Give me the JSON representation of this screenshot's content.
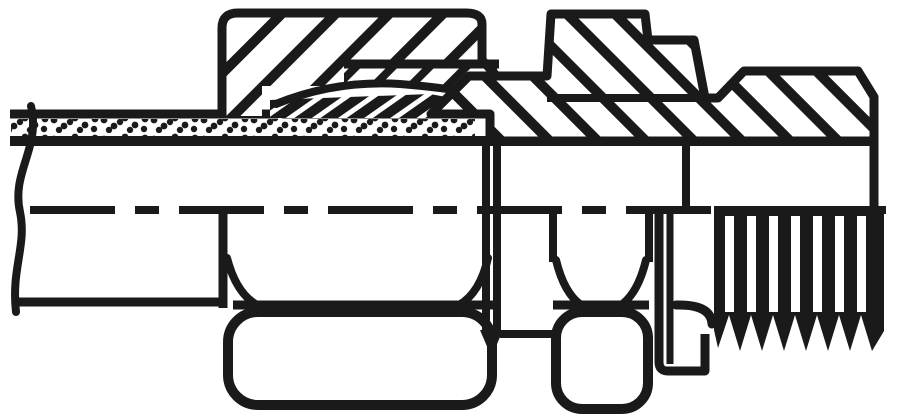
{
  "drawing": {
    "subject": "Half-section technical line drawing of a straight male stud compression fitting: tube with stippled wall, hatched union nut, cutting ring, hatched fitting body with hex, sealing cone and male thread",
    "ink_color": "#1a1a1a",
    "background_color": "#ffffff",
    "parts": [
      "tube",
      "tube-wall-stipple",
      "tube-break-line",
      "union-nut-section",
      "cutting-ring",
      "fitting-body-section",
      "body-hex",
      "union-nut-hex-flat",
      "body-hex-flat",
      "sealing-cone-step",
      "male-thread",
      "centerline"
    ]
  }
}
